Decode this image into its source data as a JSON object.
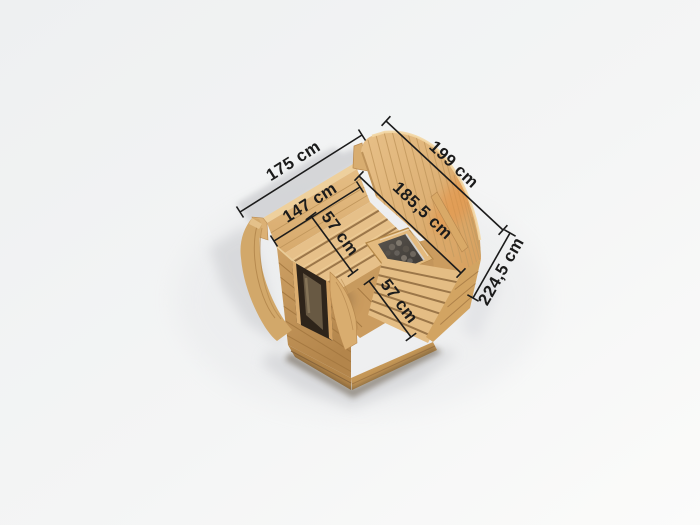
{
  "illustration": {
    "subject": "sauna-pod-dimension-diagram"
  },
  "dimensions": {
    "exterior_width": "175 cm",
    "exterior_depth": "199 cm",
    "exterior_height": "224,5 cm",
    "interior_width": "147 cm",
    "interior_depth": "185,5 cm",
    "bench_left_depth": "57 cm",
    "bench_right_depth": "57 cm"
  },
  "colors": {
    "background_top": "#eef0f1",
    "background_bottom": "#fbfbfa",
    "wood_light": "#e6c089",
    "wood_medium": "#d9ac6e",
    "wood_dark": "#b98b51",
    "wood_gap": "#8f6a3e",
    "curve_highlight": "#e78f41",
    "door_opening": "#2e241a",
    "door_glass": "#6f5f48",
    "heater_body": "#4e4a45",
    "heater_rim": "#d7d9da",
    "shadow": "#d2d3d6",
    "dimension_ink": "#1b1b1b"
  }
}
